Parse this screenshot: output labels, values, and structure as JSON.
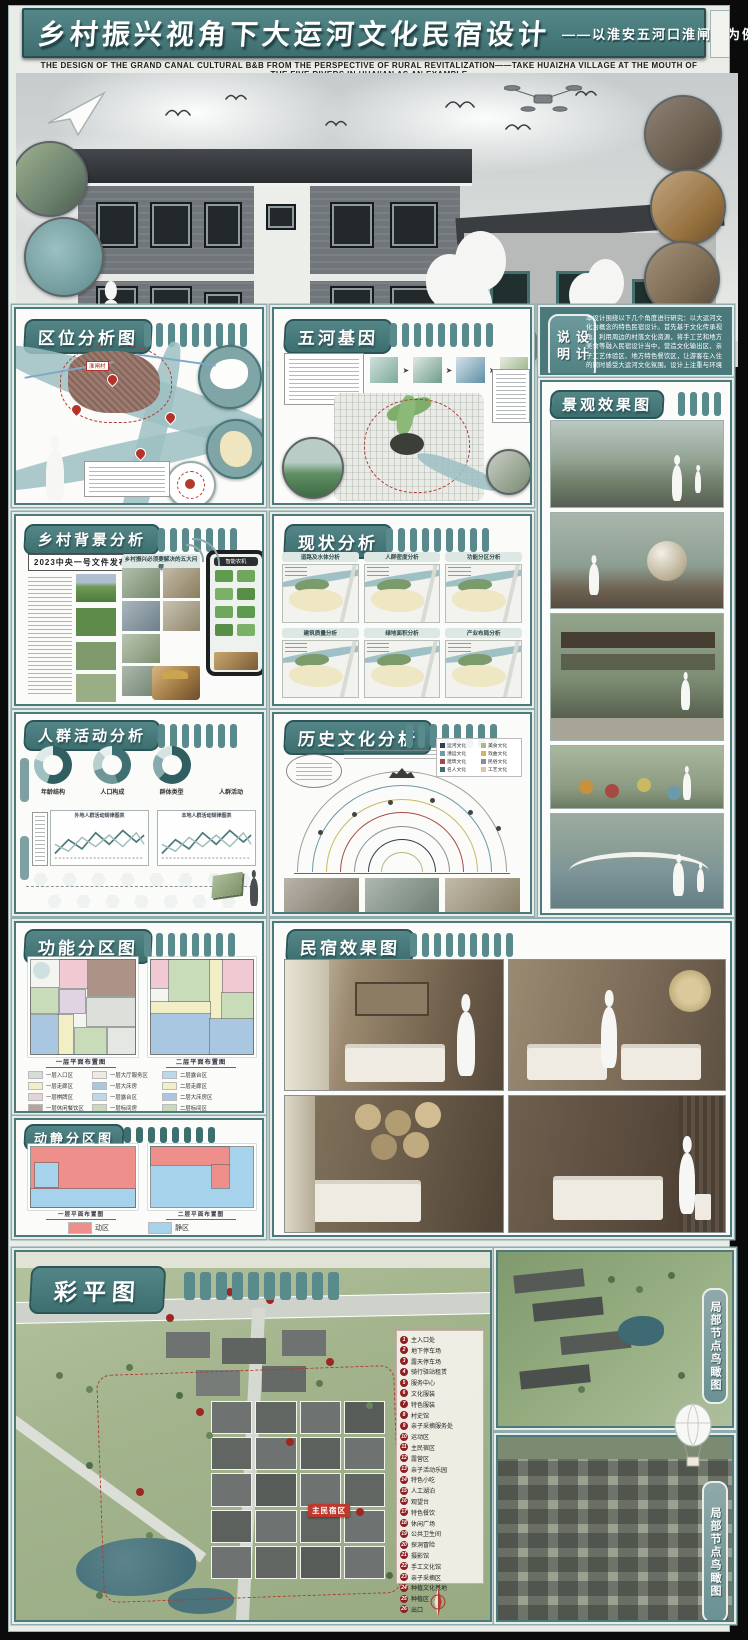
{
  "poster": {
    "title": "乡村振兴视角下大运河文化民宿设计",
    "subtitle": "——以淮安五河口淮闸村为例",
    "subtitle_en": "THE DESIGN OF THE GRAND CANAL CULTURAL B&B FROM THE PERSPECTIVE OF RURAL REVITALIZATION——TAKE HUAIZHA VILLAGE AT THE MOUTH OF THE FIVE RIVERS IN HUAI'AN AS AN EXAMPLE"
  },
  "colors": {
    "teal": "#457577",
    "teal_dark": "#2b5557",
    "teal_bar": "#598a8c",
    "frame": "#4a7a7c",
    "dynamic_red": "#ee8f8b",
    "static_blue": "#a6d2ec",
    "legend_badge": "#8f1d22"
  },
  "sections": {
    "quwei": {
      "title": "区位分析图",
      "pin_label": "淮闸村"
    },
    "wuhe": {
      "title": "五河基因"
    },
    "sheji": {
      "title": "设计说明",
      "body": "本设计围绕以下几个角度进行研究：以大运河文化为概念的特色民宿设计。首先基于文化传承视角，利用周边的村落文化资源，将手工艺和地方美食等融入民宿设计当中，营造文化输出区、亲子工艺体验区、地方特色餐饮区，让游客在入住的同时感受大运河文化氛围。设计上注重与环境的融合，采用当地传统建筑形式与材料，保留乡村的肌理与风貌，改善公共配套与环境质量，带动村民就业。整体风格上以乡土简洁为主，选用当地材料与现代工艺相结合，木材质、白墙灰瓦营造宁静氛围，注重建筑内外空间的互动性，现代与传统相呼应。打造集住宿、餐饮、休闲、亲子互动为一体的文化民宿集群，助力乡村振兴与大运河文化带建设，保护生态环境，增加绿植、绿色小道等景观元素，再生活力与宜居的村落，提升环境质量。"
    },
    "jingguan": {
      "title": "景观效果图"
    },
    "beijing": {
      "title": "乡村背景分析",
      "headline": "2023中央一号文件发布",
      "sub_headline": "乡村振兴必须要解决的五大问题",
      "phone_tag": "智能农机"
    },
    "xianzhuang": {
      "title": "现状分析",
      "maps": [
        "道路及水体分析",
        "人群密度分析",
        "功能分区分析",
        "建筑质量分析",
        "绿地面积分析",
        "产业布局分析"
      ]
    },
    "renqun": {
      "title": "人群活动分析",
      "donuts": [
        "年龄结构",
        "人口构成",
        "群体类型",
        "人群活动"
      ],
      "charts": [
        "外地人群活动规律图表",
        "本地人群活动规律图表"
      ]
    },
    "lishi": {
      "title": "历史文化分析",
      "cultures": [
        {
          "label": "运河文化",
          "color": "#2f3f52"
        },
        {
          "label": "美食文化",
          "color": "#b0b87e"
        },
        {
          "label": "漕运文化",
          "color": "#6d9aa8"
        },
        {
          "label": "戏曲文化",
          "color": "#c8b962"
        },
        {
          "label": "建筑文化",
          "color": "#a84a44"
        },
        {
          "label": "民俗文化",
          "color": "#8a8f94"
        },
        {
          "label": "名人文化",
          "color": "#3f6e70"
        },
        {
          "label": "工艺文化",
          "color": "#d8c9a0"
        }
      ]
    },
    "gongneng": {
      "title": "功能分区图",
      "caption_f1": "一层平面布置图",
      "caption_f2": "二层平面布置图",
      "legend_f1": [
        {
          "label": "一层入口区",
          "color": "#d9dcd4"
        },
        {
          "label": "一层大厅服务区",
          "color": "#eceae4"
        },
        {
          "label": "一层走廊区",
          "color": "#f2eec5"
        },
        {
          "label": "一层大床房",
          "color": "#aac7e2"
        },
        {
          "label": "一层棋牌区",
          "color": "#e3d3da"
        },
        {
          "label": "一层露台区",
          "color": "#bcd8ea"
        },
        {
          "label": "一层休闲餐饮区",
          "color": "#b5a49a"
        },
        {
          "label": "一层标间房",
          "color": "#c8dab9"
        },
        {
          "label": "一层卫生间区",
          "color": "#cfd4d8"
        },
        {
          "label": "一层景观休闲区",
          "color": "#dfe7d8"
        }
      ],
      "legend_f2": [
        {
          "label": "二层露台区",
          "color": "#bcd8ea"
        },
        {
          "label": "二层走廊区",
          "color": "#f2eec5"
        },
        {
          "label": "二层大床房区",
          "color": "#aac7e2"
        },
        {
          "label": "二层标间区",
          "color": "#c8dab9"
        },
        {
          "label": "二层卫生间区",
          "color": "#cfd4d8"
        }
      ]
    },
    "minsu": {
      "title": "民宿效果图"
    },
    "dongjing": {
      "title": "动静分区图",
      "caption_f1": "一层平面布置图",
      "caption_f2": "二层平面布置图",
      "legend": [
        {
          "label": "动区",
          "color": "#ee8f8b"
        },
        {
          "label": "静区",
          "color": "#a6d2ec"
        }
      ]
    },
    "caiping": {
      "title": "彩平图",
      "site_tag": "主民宿区",
      "legend": [
        {
          "num": "1",
          "label": "主入口处"
        },
        {
          "num": "2",
          "label": "地下停车场"
        },
        {
          "num": "3",
          "label": "露天停车场"
        },
        {
          "num": "4",
          "label": "骑行驿站租赁"
        },
        {
          "num": "5",
          "label": "服务中心"
        },
        {
          "num": "6",
          "label": "文化服装"
        },
        {
          "num": "7",
          "label": "特色服装"
        },
        {
          "num": "8",
          "label": "村史馆"
        },
        {
          "num": "9",
          "label": "亲子采摘服务处"
        },
        {
          "num": "10",
          "label": "运动区"
        },
        {
          "num": "11",
          "label": "主民宿区"
        },
        {
          "num": "12",
          "label": "露营区"
        },
        {
          "num": "13",
          "label": "亲子活动乐园"
        },
        {
          "num": "14",
          "label": "特色小吃"
        },
        {
          "num": "15",
          "label": "人工湖泊"
        },
        {
          "num": "16",
          "label": "观望台"
        },
        {
          "num": "17",
          "label": "特色餐饮"
        },
        {
          "num": "18",
          "label": "休闲广场"
        },
        {
          "num": "19",
          "label": "公共卫生间"
        },
        {
          "num": "20",
          "label": "探洞冒险"
        },
        {
          "num": "21",
          "label": "摄影馆"
        },
        {
          "num": "22",
          "label": "手工文化馆"
        },
        {
          "num": "23",
          "label": "亲子采摘区"
        },
        {
          "num": "24",
          "label": "种植文化基地"
        },
        {
          "num": "25",
          "label": "种植区"
        },
        {
          "num": "26",
          "label": "出口"
        }
      ]
    },
    "niaokan": {
      "title": "局部节点鸟瞰图"
    }
  }
}
